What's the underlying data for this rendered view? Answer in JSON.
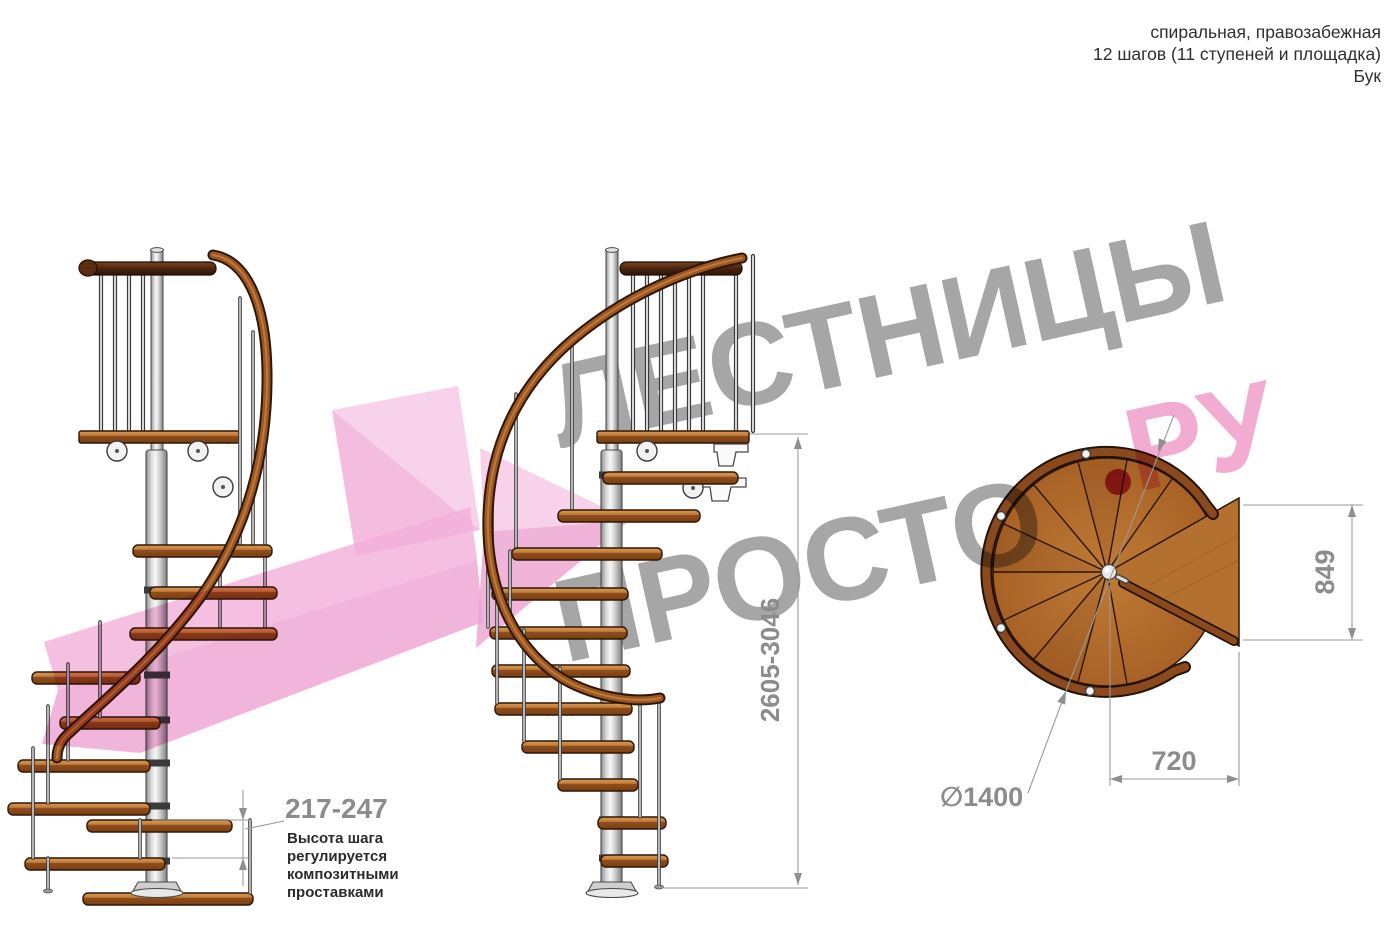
{
  "header": {
    "line1": "спиральная, правозабежная",
    "line2": "12 шагов (11 ступеней и площадка)",
    "line3": "Бук"
  },
  "watermark": {
    "word1": "ЛЕСТНИЦЫ",
    "word2": "ПРОСТО",
    "word3": "РУ"
  },
  "annotations": {
    "step_height_value": "217-247",
    "step_height_note": [
      "Высота шага",
      "регулируется",
      "композитными",
      "проставками"
    ],
    "total_height_value": "2605-3046",
    "platform_depth_value": "849",
    "platform_width_value": "720",
    "diameter_value": "∅1400"
  },
  "colors": {
    "wood": "#b26c2c",
    "wood_dark": "#7a3e12",
    "metal": "#d9d9d9",
    "watermark_gray": "#9a9a9a",
    "watermark_pink": "#f2a7cf",
    "watermark_dot": "#c12a5e",
    "arrow_pink": "#f3b5dc",
    "dimension_gray": "#8f8f8f",
    "note_text": "#2b2b2b"
  }
}
